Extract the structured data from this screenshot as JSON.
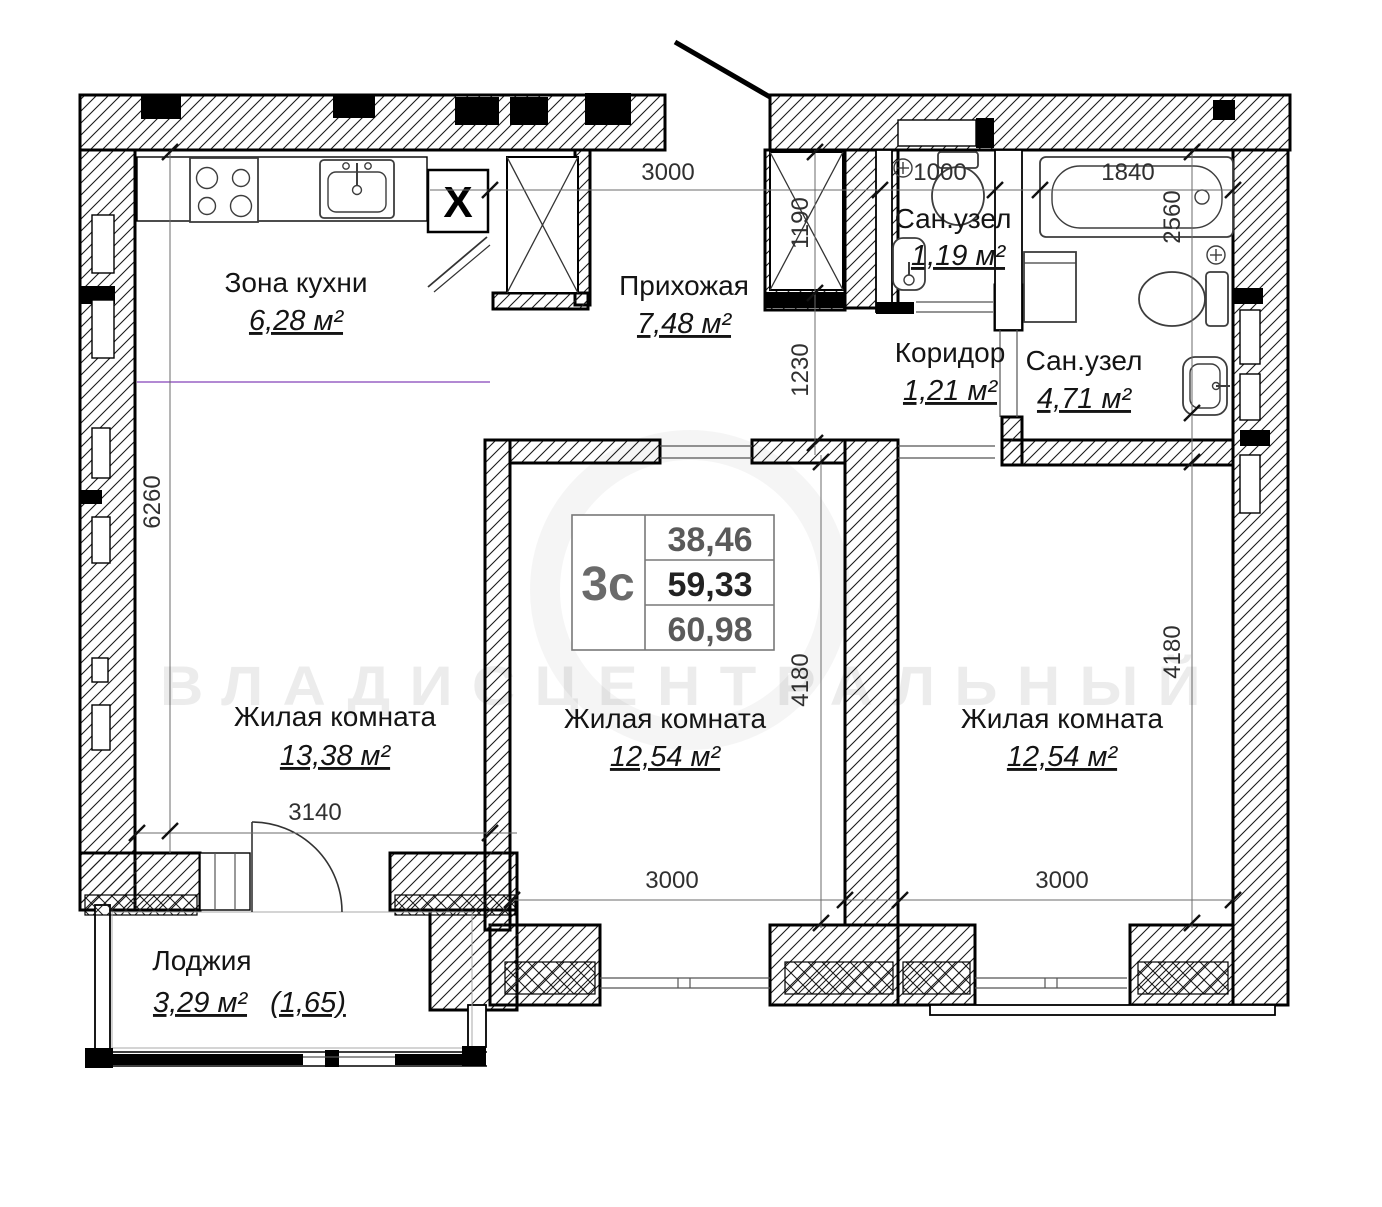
{
  "apartment": {
    "plan_code": "3с",
    "area_living": "38,46",
    "area_usable": "59,33",
    "area_total": "60,98"
  },
  "rooms": [
    {
      "name": "Зона кухни",
      "area": "6,28 м²"
    },
    {
      "name": "Прихожая",
      "area": "7,48 м²"
    },
    {
      "name": "Сан.узел",
      "area": "1,19 м²"
    },
    {
      "name": "Коридор",
      "area": "1,21 м²"
    },
    {
      "name": "Сан.узел",
      "area": "4,71 м²"
    },
    {
      "name": "Жилая комната",
      "area": "13,38 м²"
    },
    {
      "name": "Жилая комната",
      "area": "12,54 м²"
    },
    {
      "name": "Жилая комната",
      "area": "12,54 м²"
    },
    {
      "name": "Лоджия",
      "area": "3,29 м²",
      "area_coefficient": "(1,65)"
    }
  ],
  "dimensions": {
    "hall_width": "3000",
    "entry_niche_depth": "1190",
    "entry_passage": "1230",
    "wc_small_width": "1000",
    "bathtub_length": "1840",
    "bathroom_depth": "2560",
    "left_wall_height": "6260",
    "living1_width": "3140",
    "living2_height": "4180",
    "living2_width": "3000",
    "living3_height": "4180",
    "living3_width": "3000"
  },
  "symbols": {
    "vent": "X"
  },
  "watermark": "ВЛАДИСЦЕНТРАЛЬНЫЙ",
  "colors": {
    "walls": "#000000",
    "dimension_text": "#303030",
    "kitchen_zone_line": "#a06cc9",
    "table_muted_text": "#5a5a5a"
  }
}
